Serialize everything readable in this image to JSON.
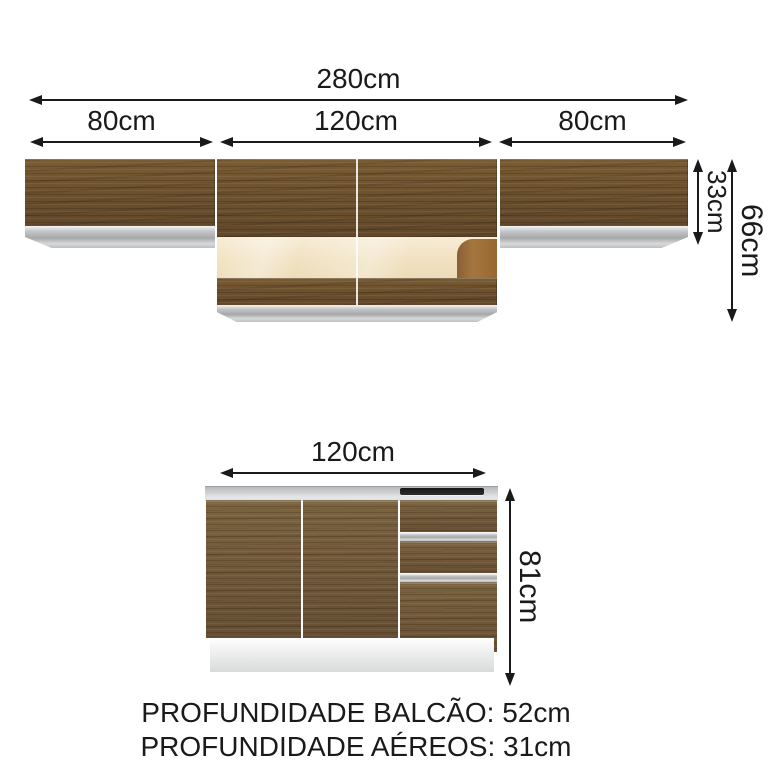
{
  "dims": {
    "total_width": "280cm",
    "upper_left_width": "80cm",
    "upper_middle_width": "120cm",
    "upper_right_width": "80cm",
    "upper_door_height": "33cm",
    "upper_total_height": "66cm",
    "base_width": "120cm",
    "base_height": "81cm"
  },
  "footer": {
    "depth_base": "PROFUNDIDADE BALCÃO: 52cm",
    "depth_upper": "PROFUNDIDADE AÉREOS: 31cm"
  },
  "colors": {
    "wood": "#6e5230",
    "wood_base": "#72593a",
    "glass": "#f1e1c0",
    "silver": "#c3c4c6",
    "line": "#1a1a1a",
    "plinth": "#e2e2e2"
  }
}
